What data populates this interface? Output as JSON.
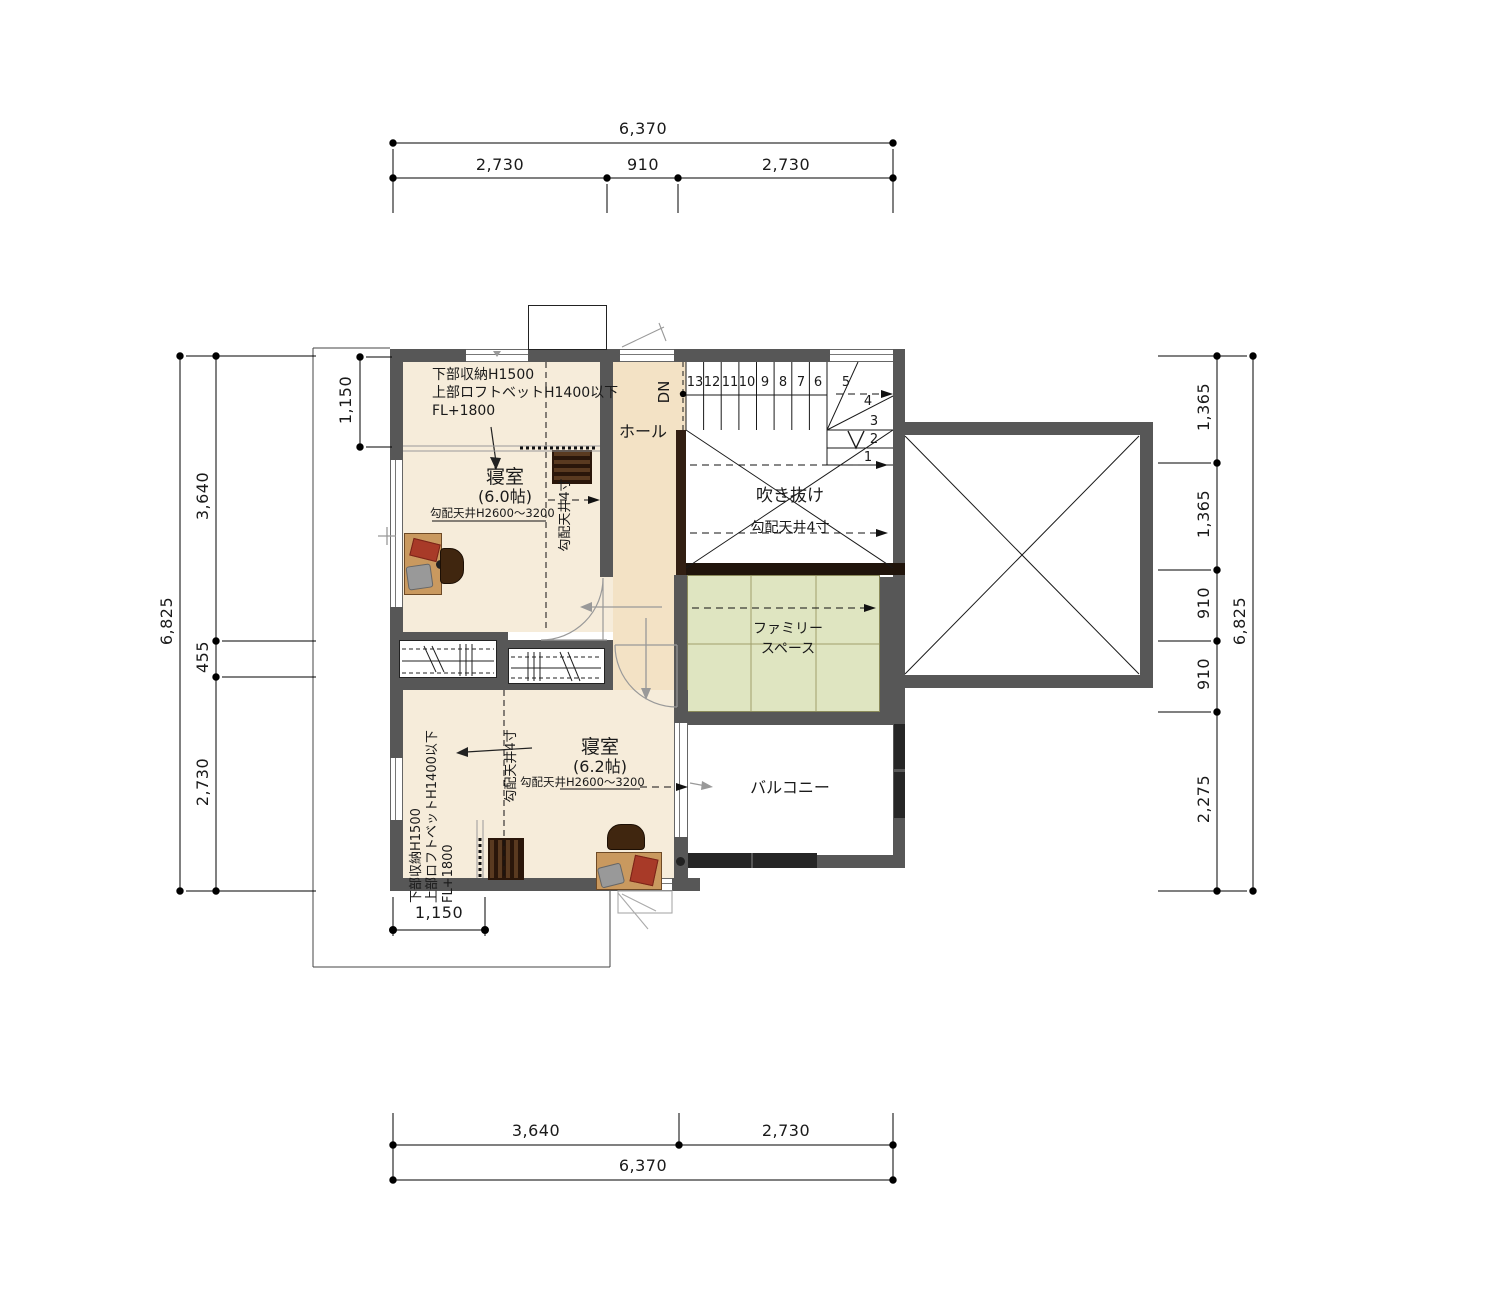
{
  "title": "2F plan",
  "colors": {
    "wall": "#575757",
    "parapet": "#262626",
    "beam": "#20140b",
    "floor_bedroom": "#f6ecda",
    "floor_hall": "#f3e2c5",
    "floor_family": "#dfe5c1",
    "desk_wood": "#c9995f",
    "dark_wood": "#40260f",
    "book_red": "#a83a28",
    "bag_gray": "#999999"
  },
  "dimensions": {
    "top": {
      "total": "6,370",
      "segments": [
        "2,730",
        "910",
        "2,730"
      ]
    },
    "bottom": {
      "total": "6,370",
      "segments": [
        "3,640",
        "2,730"
      ]
    },
    "left": {
      "total": "6,825",
      "segments": [
        "3,640",
        "455",
        "2,730"
      ],
      "offset_top": "1,150",
      "offset_bottom": "1,150"
    },
    "right": {
      "total": "6,825",
      "segments": [
        "1,365",
        "1,365",
        "910",
        "910",
        "2,275"
      ]
    }
  },
  "rooms": {
    "bedroom1": {
      "name": "寝室",
      "size": "(6.0帖)",
      "ceiling": "勾配天井H2600～3200",
      "slope": "勾配天井4寸",
      "notes": [
        "下部収納H1500",
        "上部ロフトベットH1400以下",
        "FL+1800"
      ]
    },
    "bedroom2": {
      "name": "寝室",
      "size": "(6.2帖)",
      "ceiling": "勾配天井H2600～3200",
      "slope": "勾配天井4寸",
      "notes": [
        "下部収納H1500",
        "上部ロフトベットH1400以下",
        "FL+1800"
      ]
    },
    "hall": {
      "name": "ホール"
    },
    "void": {
      "name": "吹き抜け",
      "slope": "勾配天井4寸"
    },
    "family_space": {
      "name_line1": "ファミリー",
      "name_line2": "スペース"
    },
    "balcony": {
      "name": "バルコニー"
    }
  },
  "stairs": {
    "direction": "DN",
    "treads": [
      "13",
      "12",
      "11",
      "10",
      "9",
      "8",
      "7",
      "6",
      "5",
      "4",
      "3",
      "2",
      "1"
    ]
  }
}
